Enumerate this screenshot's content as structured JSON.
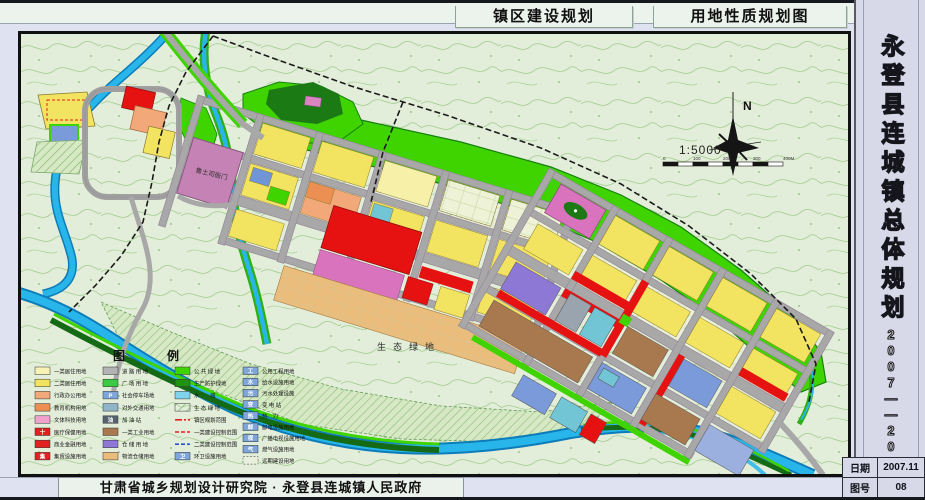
{
  "header": {
    "tab1": "镇区建设规划",
    "tab2": "用地性质规划图"
  },
  "sidebar": {
    "title": "永登县连城镇总体规划",
    "period": "2007——2020"
  },
  "footer": {
    "credit": "甘肃省城乡规划设计研究院 · 永登县连城镇人民政府"
  },
  "info_table": {
    "rows": [
      {
        "label": "日期",
        "value": "2007.11"
      },
      {
        "label": "图号",
        "value": "08"
      }
    ]
  },
  "map": {
    "labels": {
      "heritage": "鲁土司衙门",
      "eco": "生态绿地"
    },
    "compass_n": "N",
    "scale_text": "1:5000",
    "scale_ticks": [
      "0",
      "100",
      "200",
      "300",
      "400M"
    ]
  },
  "legend": {
    "title": "图　　例",
    "columns": [
      {
        "items": [
          {
            "label": "一类居住用地",
            "kind": "fill",
            "color": "#f8f3b4"
          },
          {
            "label": "二类居住用地",
            "kind": "fill",
            "color": "#f2e360"
          },
          {
            "label": "行政办公用地",
            "kind": "fill",
            "color": "#f2a878"
          },
          {
            "label": "教育机构用地",
            "kind": "fill",
            "color": "#ec8f52"
          },
          {
            "label": "文体科技用地",
            "kind": "fill",
            "color": "#f0a2cc"
          },
          {
            "label": "医疗保健用地",
            "kind": "fill",
            "color": "#e32020",
            "glyph": "十"
          },
          {
            "label": "商业金融用地",
            "kind": "fill",
            "color": "#e32020"
          },
          {
            "label": "集贸设施用地",
            "kind": "fill",
            "color": "#e32020",
            "glyph": "集"
          }
        ]
      },
      {
        "items": [
          {
            "label": "道 路 用 地",
            "kind": "fill",
            "color": "#b3b3b3"
          },
          {
            "label": "广 场 用 地",
            "kind": "fill",
            "color": "#3cc944"
          },
          {
            "label": "社会停车场地",
            "kind": "fill",
            "color": "#7fa6da",
            "glyph": "P"
          },
          {
            "label": "对外交通用地",
            "kind": "fill",
            "color": "#8fb5c9"
          },
          {
            "label": "加 油 站",
            "kind": "fill",
            "color": "#56636e",
            "glyph": "油"
          },
          {
            "label": "一类工业用地",
            "kind": "fill",
            "color": "#a8794f"
          },
          {
            "label": "仓 储 用 地",
            "kind": "fill",
            "color": "#8d78d6"
          },
          {
            "label": "物流仓储用地",
            "kind": "fill",
            "color": "#eabd7d"
          }
        ]
      },
      {
        "items": [
          {
            "label": "公 共 绿 地",
            "kind": "fill",
            "color": "#3fd400"
          },
          {
            "label": "生产防护绿地",
            "kind": "fill",
            "color": "#1f9212"
          },
          {
            "label": "水　　域",
            "kind": "fill",
            "color": "#7fd4ec"
          },
          {
            "label": "生 态 绿 地",
            "kind": "hatch",
            "color": "#9cc98c"
          },
          {
            "label": "镇区规划范围",
            "kind": "line",
            "color": "#e32020",
            "dash": "7,2,2,2"
          },
          {
            "label": "一类建设控制范围",
            "kind": "line",
            "color": "#e32020",
            "dash": "4,2"
          },
          {
            "label": "二类建设控制范围",
            "kind": "line",
            "color": "#2a52c9",
            "dash": "4,2"
          },
          {
            "label": "环卫设施用地",
            "kind": "fill",
            "color": "#7fa6da",
            "glyph": "卫"
          }
        ]
      },
      {
        "items": [
          {
            "label": "公用工程用地",
            "kind": "fill",
            "color": "#7fa6da",
            "glyph": "工"
          },
          {
            "label": "给水设施用地",
            "kind": "fill",
            "color": "#7fa6da",
            "glyph": "水"
          },
          {
            "label": "污水处理设施",
            "kind": "fill",
            "color": "#7fa6da",
            "glyph": "污"
          },
          {
            "label": "变 电 站",
            "kind": "fill",
            "color": "#7fa6da",
            "glyph": "变"
          },
          {
            "label": "热　力",
            "kind": "fill",
            "color": "#7fa6da",
            "glyph": "热"
          },
          {
            "label": "邮电设施用地",
            "kind": "fill",
            "color": "#7fa6da",
            "glyph": "邮"
          },
          {
            "label": "广播电视设施用地",
            "kind": "fill",
            "color": "#7fa6da",
            "glyph": "视"
          },
          {
            "label": "燃气设施用地",
            "kind": "fill",
            "color": "#7fa6da",
            "glyph": "气"
          },
          {
            "label": "远期建设用地",
            "kind": "dashfill",
            "color": "#e8efdc"
          }
        ]
      }
    ]
  },
  "colors": {
    "residential_yellow": "#f2e360",
    "commercial_red": "#e61212",
    "industry_brown": "#a8794f",
    "warehouse_purple": "#8d78d6",
    "green_space": "#3fd400",
    "water": "#28b6ea",
    "road_gray": "#a8a8a8"
  }
}
